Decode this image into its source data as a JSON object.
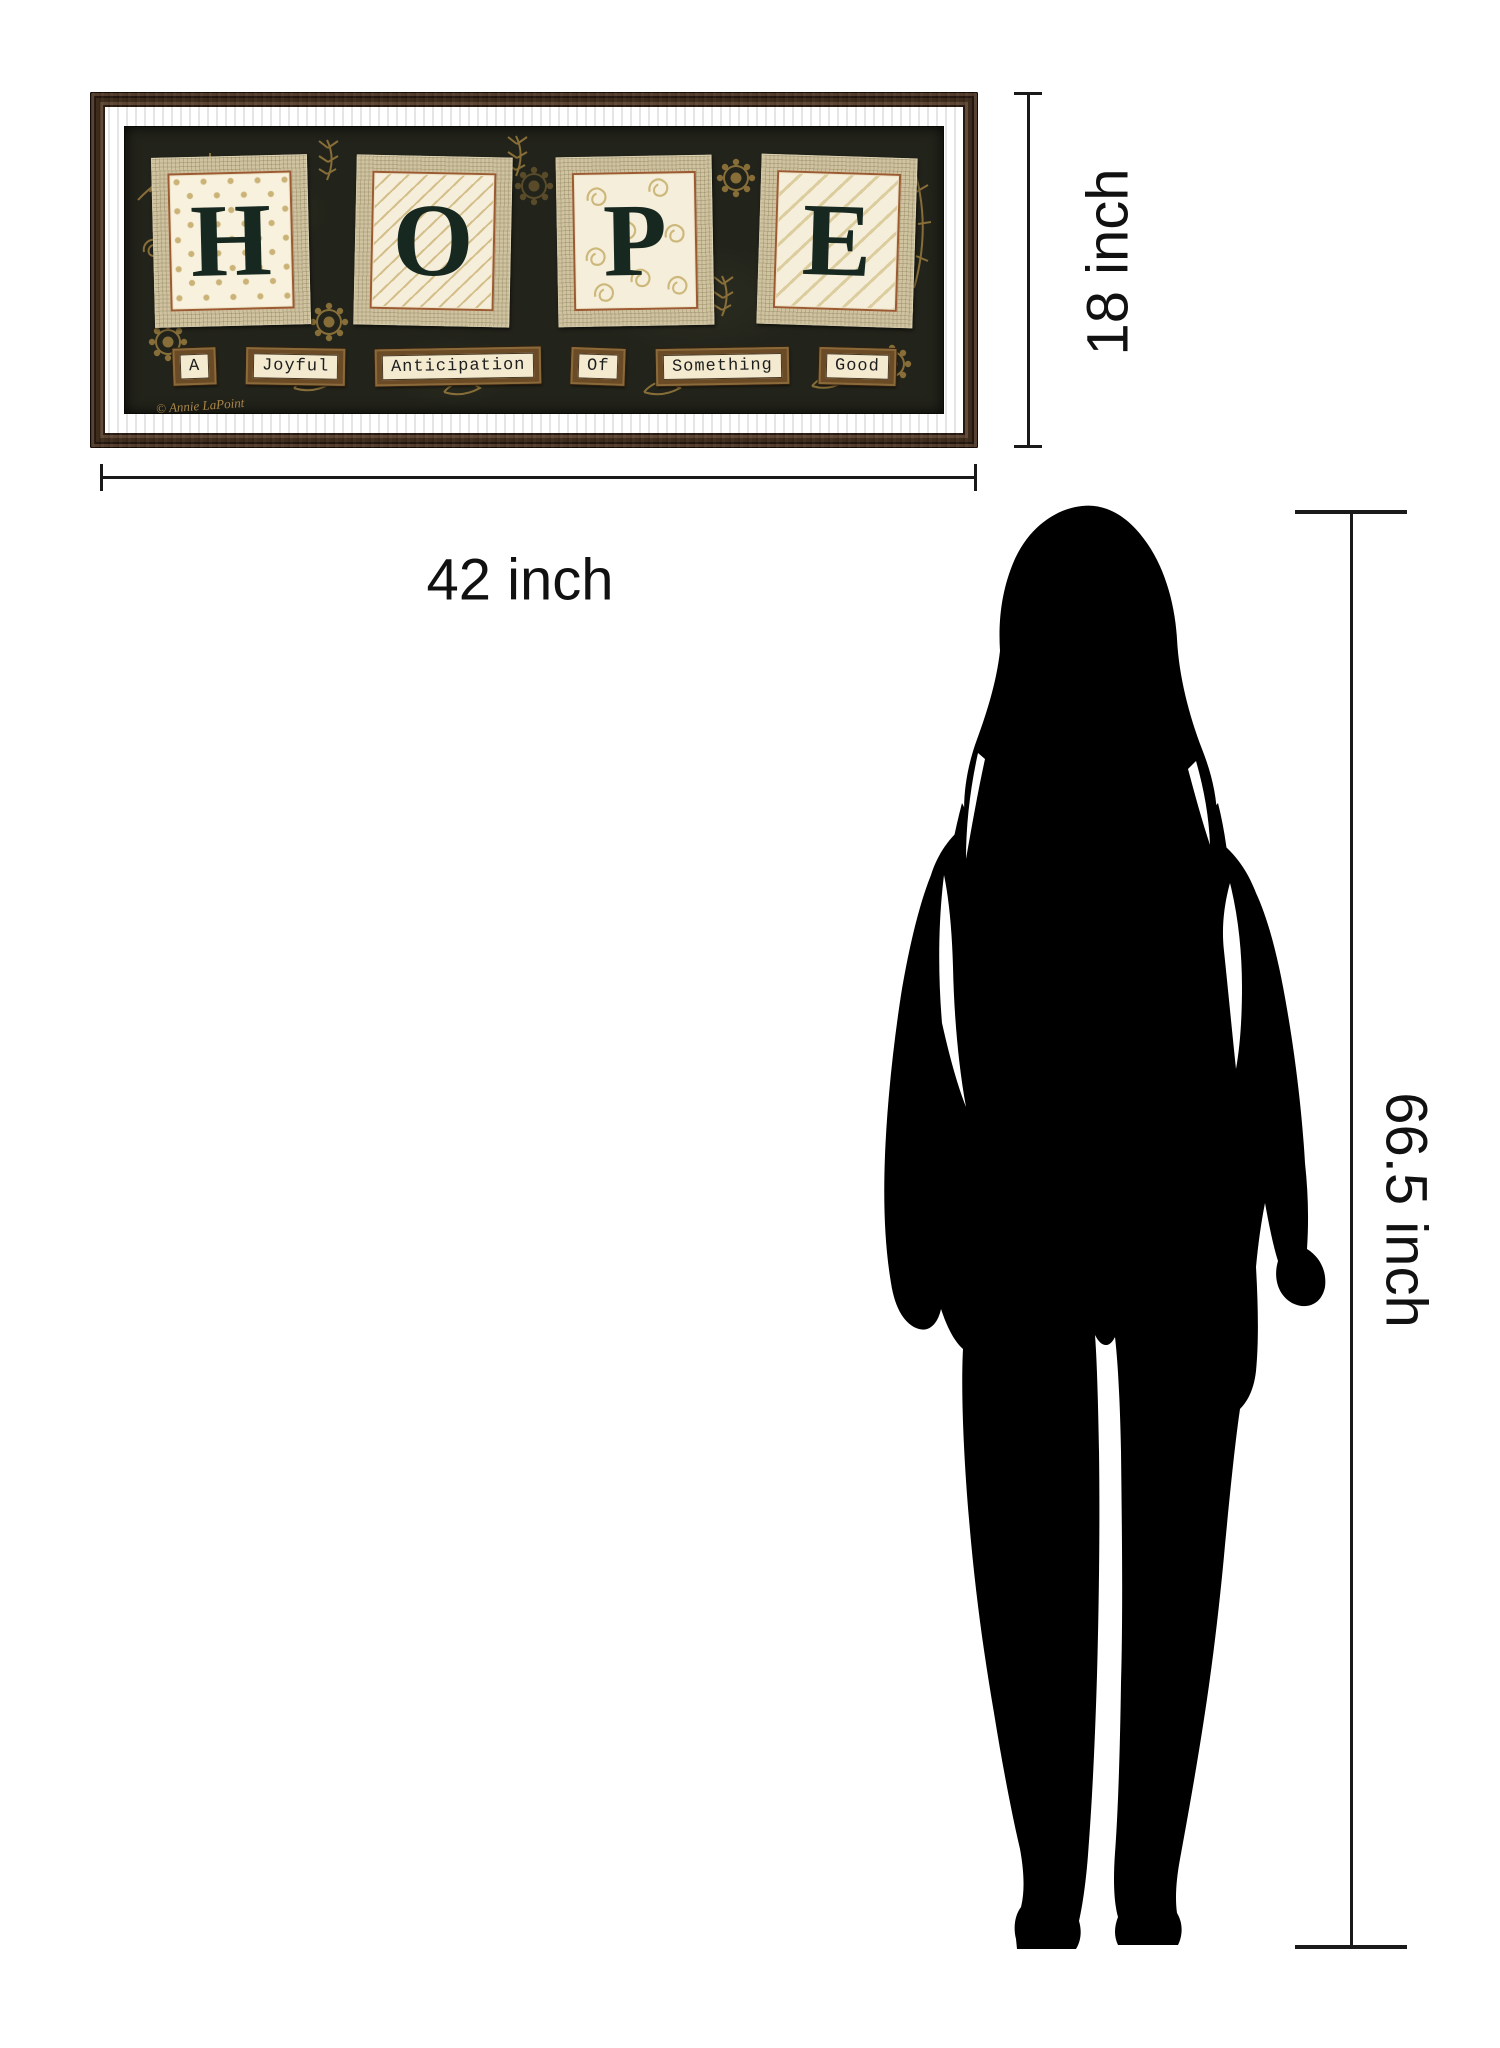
{
  "artwork": {
    "word": "HOPE",
    "tiles": [
      {
        "letter": "H",
        "pattern": "polka-dots"
      },
      {
        "letter": "O",
        "pattern": "diagonal-stripes"
      },
      {
        "letter": "P",
        "pattern": "swirls"
      },
      {
        "letter": "E",
        "pattern": "diagonal-stripes-wide"
      }
    ],
    "caption_words": [
      "A",
      "Joyful",
      "Anticipation",
      "Of",
      "Something",
      "Good"
    ],
    "signature": "© Annie LaPoint",
    "colors": {
      "frame_wood": "#3f2b20",
      "art_background": "#22231a",
      "burlap": "#cfc3a0",
      "paper": "#f5eeda",
      "paper_border": "#9c5a33",
      "letter": "#16281f",
      "ornament_gold": "#9a7c3f",
      "plaque_face": "#6b4a26",
      "plaque_border": "#8a6a3a",
      "plaque_paper": "#f3ead0"
    }
  },
  "dimensions": {
    "width_label": "42 inch",
    "height_label": "18 inch",
    "figure_height_label": "66.5 inch",
    "line_color": "#1a1a1a"
  },
  "figure": {
    "icon": "woman-silhouette",
    "color": "#000000"
  }
}
